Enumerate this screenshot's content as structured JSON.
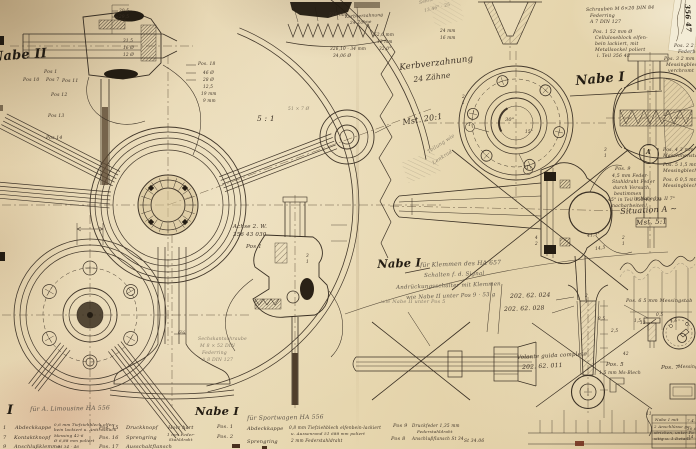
{
  "colors": {
    "paper": "#e6d6ae",
    "ink": "#3c3126",
    "ink_dark": "#241d13",
    "pencil": "#8a7f6b",
    "tape_dark": "#221a10",
    "patch_white": "#f3ecd6",
    "red_mark": "#6e2a18"
  },
  "texts": {
    "headings": [
      {
        "n": "nabe2-title",
        "t": "Nabe II",
        "x": -9,
        "y": 51,
        "s": 13,
        "r": -4,
        "st": "heavy"
      },
      {
        "n": "kerbverzahnung-label",
        "t": "Kerbverzahnung",
        "x": 399,
        "y": 64,
        "s": 8.5,
        "r": -7
      },
      {
        "n": "kerbverzahnung-teeth",
        "t": "24 Zähne",
        "x": 413,
        "y": 76,
        "s": 7.5,
        "r": -7
      },
      {
        "n": "scale-20-1",
        "t": "Mst. 20:1",
        "x": 402,
        "y": 119,
        "s": 8,
        "r": -9
      },
      {
        "n": "nabe1-top-title",
        "t": "Nabe I",
        "x": 575,
        "y": 75,
        "s": 13,
        "r": -5,
        "st": "heavy"
      },
      {
        "n": "nabe1-center-title",
        "t": "Nabe I",
        "x": 377,
        "y": 259,
        "s": 11.5,
        "r": -2,
        "st": "heavy"
      },
      {
        "n": "situation-a-title",
        "t": "Situation A ~",
        "x": 620,
        "y": 208,
        "s": 8,
        "r": -3
      },
      {
        "n": "situation-a-scale",
        "t": "Mst. 5:1",
        "x": 636,
        "y": 220,
        "s": 7,
        "r": -3
      },
      {
        "n": "nabe1-bottom-title",
        "t": "Nabe I",
        "x": 195,
        "y": 406,
        "s": 11.5,
        "r": 0,
        "st": "heavy"
      },
      {
        "n": "bottom-left-numeral",
        "t": "I",
        "x": 7,
        "y": 404,
        "s": 13,
        "r": 0,
        "st": "heavy"
      },
      {
        "n": "scale-5-1",
        "t": "5 : 1",
        "x": 257,
        "y": 115,
        "s": 7.5
      },
      {
        "n": "patch-number",
        "t": "356 47",
        "x": 691,
        "y": 4,
        "s": 7,
        "r": 87,
        "st": "heavy"
      }
    ],
    "notes": [
      {
        "t": "für Klemmen des HA 657",
        "x": 420,
        "y": 263,
        "s": 6,
        "r": -2,
        "st": "pencil2"
      },
      {
        "t": "Schalten f. d. Signal",
        "x": 424,
        "y": 274,
        "s": 5.5,
        "r": -2,
        "st": "pencil2"
      },
      {
        "t": "Andrückungsschalter mit Klemmen",
        "x": 396,
        "y": 286,
        "s": 5.5,
        "r": -2,
        "st": "pencil2"
      },
      {
        "t": "wie Nabe II unter Pos 9 · 53 g",
        "x": 406,
        "y": 296,
        "s": 5.5,
        "r": -2,
        "st": "pencil2"
      },
      {
        "t": "für A. Limousine HA 556",
        "x": 30,
        "y": 407,
        "s": 6,
        "r": -1,
        "st": "pencil2"
      },
      {
        "t": "für Sportwagen HA 556",
        "x": 247,
        "y": 416,
        "s": 6,
        "r": -1,
        "st": "pencil2"
      },
      {
        "t": "Pos. 9",
        "x": 615,
        "y": 168,
        "s": 4.8
      },
      {
        "t": "4,5 mm Feder-",
        "x": 612,
        "y": 175,
        "s": 4.6
      },
      {
        "t": "Stahldraht Feder",
        "x": 612,
        "y": 181,
        "s": 4.6
      },
      {
        "t": "durch Versuch",
        "x": 613,
        "y": 187,
        "s": 4.6
      },
      {
        "t": "bestimmen",
        "x": 614,
        "y": 193,
        "s": 4.6
      },
      {
        "t": "45° in Teil 356 43 033",
        "x": 608,
        "y": 199,
        "s": 4.4
      },
      {
        "t": "nacharbeiten!",
        "x": 612,
        "y": 205,
        "s": 4.6
      },
      {
        "t": "Pos. 2  2 mm",
        "x": 674,
        "y": 45,
        "s": 4.6
      },
      {
        "t": "Federblech",
        "x": 678,
        "y": 51,
        "s": 4.6
      },
      {
        "t": "Pos. 3  2 mm",
        "x": 664,
        "y": 58,
        "s": 4.6
      },
      {
        "t": "Messingblech",
        "x": 666,
        "y": 64,
        "s": 4.6
      },
      {
        "t": "verchromt",
        "x": 668,
        "y": 70,
        "s": 4.6
      },
      {
        "t": "Pos. 4  3 mm",
        "x": 663,
        "y": 149,
        "s": 4.6
      },
      {
        "t": "Maschinenstahl",
        "x": 663,
        "y": 155,
        "s": 4.6
      },
      {
        "t": "Pos. 5  1,5 mm",
        "x": 663,
        "y": 164,
        "s": 4.6
      },
      {
        "t": "Messingblech",
        "x": 663,
        "y": 170,
        "s": 4.6
      },
      {
        "t": "Pos. 6  0,5 mm",
        "x": 663,
        "y": 179,
        "s": 4.6
      },
      {
        "t": "Messingblech",
        "x": 663,
        "y": 185,
        "s": 4.6
      },
      {
        "t": "in Nabe I u. II  7°",
        "x": 634,
        "y": 198,
        "s": 4.4
      },
      {
        "t": "Schrauben M 6×20 DIN 84",
        "x": 586,
        "y": 9,
        "s": 4.6,
        "r": -2
      },
      {
        "t": "Federring",
        "x": 590,
        "y": 15,
        "s": 4.6
      },
      {
        "t": "A 7 DIN 127",
        "x": 590,
        "y": 21,
        "s": 4.6
      },
      {
        "t": "Pos. 1   52 mm Ø",
        "x": 593,
        "y": 31,
        "s": 4.6
      },
      {
        "t": "Celluloseblock elfen-",
        "x": 595,
        "y": 37,
        "s": 4.6
      },
      {
        "t": "bein lackiert, mit",
        "x": 595,
        "y": 43,
        "s": 4.6
      },
      {
        "t": "Metallsockel poliert",
        "x": 595,
        "y": 49,
        "s": 4.6
      },
      {
        "t": "i. Teil 356 43",
        "x": 597,
        "y": 55,
        "s": 4.6
      },
      {
        "t": "Achse 2. W.",
        "x": 233,
        "y": 225,
        "s": 5.5
      },
      {
        "t": "356 43 030",
        "x": 233,
        "y": 233,
        "s": 5.5
      },
      {
        "t": "Pos 1",
        "x": 246,
        "y": 245,
        "s": 5.5
      },
      {
        "t": "Sechskantschraube",
        "x": 198,
        "y": 338,
        "s": 4.6,
        "st": "pencil"
      },
      {
        "t": "M 8 × 52 DIN",
        "x": 200,
        "y": 345,
        "s": 4.6,
        "st": "pencil"
      },
      {
        "t": "Federring",
        "x": 202,
        "y": 352,
        "s": 4.6,
        "st": "pencil"
      },
      {
        "t": "A 8 DIN 127",
        "x": 202,
        "y": 359,
        "s": 4.6,
        "st": "pencil"
      },
      {
        "t": "Teilung wie",
        "x": 427,
        "y": 151,
        "s": 5,
        "r": -33,
        "st": "pencil"
      },
      {
        "t": "Lenkrad",
        "x": 432,
        "y": 162,
        "s": 5,
        "r": -33,
        "st": "pencil"
      },
      {
        "t": "202. 62. 024",
        "x": 510,
        "y": 294,
        "s": 6,
        "r": -2
      },
      {
        "t": "202. 62. 028",
        "x": 504,
        "y": 307,
        "s": 6,
        "r": -2
      },
      {
        "t": "Volante guida completo",
        "x": 517,
        "y": 356,
        "s": 5.5,
        "r": -3
      },
      {
        "t": "202. 62. 011",
        "x": 522,
        "y": 365,
        "s": 6,
        "r": -3
      },
      {
        "t": "Pos. 6  5 mm Messingstab",
        "x": 626,
        "y": 300,
        "s": 4.8
      },
      {
        "t": "Pos. 5",
        "x": 606,
        "y": 363,
        "s": 5.5
      },
      {
        "t": "1,5 mm Ms-Blech",
        "x": 599,
        "y": 372,
        "s": 4.4
      },
      {
        "t": "Pos. 7",
        "x": 661,
        "y": 366,
        "s": 5.5
      },
      {
        "t": "Messing",
        "x": 678,
        "y": 366,
        "s": 4.4
      },
      {
        "t": "wie Nabe II unter Pos 5",
        "x": 381,
        "y": 300,
        "s": 5,
        "st": "pencil"
      },
      {
        "t": "Kerbverzahnung",
        "x": 345,
        "y": 15,
        "s": 4.2,
        "r": -3
      },
      {
        "t": "24 Zähne",
        "x": 350,
        "y": 21,
        "s": 4.2,
        "r": -3
      },
      {
        "t": "51 × 7 Ø",
        "x": 288,
        "y": 108,
        "s": 4.4,
        "st": "pencil"
      }
    ],
    "dimensions": [
      {
        "t": "320 mm",
        "x": 329,
        "y": 13,
        "s": 4.2
      },
      {
        "t": "326,10 · 34 mm",
        "x": 330,
        "y": 47,
        "s": 4.2
      },
      {
        "t": "34,06 Ø",
        "x": 333,
        "y": 54,
        "s": 4.2
      },
      {
        "t": "30,5",
        "x": 119,
        "y": 9,
        "s": 4.2
      },
      {
        "t": "29,5",
        "x": 119,
        "y": 15,
        "s": 4.2
      },
      {
        "t": "31,5",
        "x": 123,
        "y": 39,
        "s": 4.2
      },
      {
        "t": "16 Ø",
        "x": 123,
        "y": 46,
        "s": 4.2
      },
      {
        "t": "12 Ø",
        "x": 123,
        "y": 53,
        "s": 4.2
      },
      {
        "t": "Pos. 18",
        "x": 198,
        "y": 63,
        "s": 4.4
      },
      {
        "t": "46 Ø",
        "x": 203,
        "y": 71,
        "s": 4.2
      },
      {
        "t": "28 Ø",
        "x": 203,
        "y": 78,
        "s": 4.2
      },
      {
        "t": "12,5",
        "x": 203,
        "y": 85,
        "s": 4.2
      },
      {
        "t": "19 mm",
        "x": 201,
        "y": 92,
        "s": 4.2
      },
      {
        "t": "9 mm",
        "x": 203,
        "y": 99,
        "s": 4.2
      },
      {
        "t": "Pos 1",
        "x": 44,
        "y": 71,
        "s": 4.6
      },
      {
        "t": "Pos 10",
        "x": 23,
        "y": 79,
        "s": 4.6
      },
      {
        "t": "Pos 7",
        "x": 46,
        "y": 79,
        "s": 4.6
      },
      {
        "t": "Pos 11",
        "x": 62,
        "y": 80,
        "s": 4.6
      },
      {
        "t": "Pos 12",
        "x": 51,
        "y": 94,
        "s": 4.6
      },
      {
        "t": "Pos 13",
        "x": 48,
        "y": 115,
        "s": 4.6
      },
      {
        "t": "Pos 14",
        "x": 46,
        "y": 137,
        "s": 4.6
      },
      {
        "t": "52,0 mm",
        "x": 374,
        "y": 33,
        "s": 4.2
      },
      {
        "t": "12 mm",
        "x": 377,
        "y": 40,
        "s": 4.2
      },
      {
        "t": "32,0°",
        "x": 379,
        "y": 47,
        "s": 4.2
      },
      {
        "t": "Sehne 13 mm",
        "x": 419,
        "y": 2,
        "s": 4.4,
        "r": -14,
        "st": "pencil"
      },
      {
        "t": "13,46° · 25",
        "x": 424,
        "y": 10,
        "s": 4.4,
        "r": -14,
        "st": "pencil"
      },
      {
        "t": "24 mm",
        "x": 440,
        "y": 29,
        "s": 4.2
      },
      {
        "t": "16 mm",
        "x": 440,
        "y": 36,
        "s": 4.2
      },
      {
        "t": "30°",
        "x": 505,
        "y": 118,
        "s": 5
      },
      {
        "t": "15°",
        "x": 525,
        "y": 130,
        "s": 4.2
      },
      {
        "t": "1",
        "x": 468,
        "y": 124,
        "s": 4.5
      },
      {
        "t": "1",
        "x": 526,
        "y": 167,
        "s": 4.5
      },
      {
        "t": "A",
        "x": 646,
        "y": 150,
        "s": 6,
        "st": "heavy"
      },
      {
        "t": "41,5°",
        "x": 587,
        "y": 235,
        "s": 4.4,
        "r": -8
      },
      {
        "t": "14,5",
        "x": 595,
        "y": 248,
        "s": 4.4,
        "r": -8
      },
      {
        "t": "0,5",
        "x": 656,
        "y": 313,
        "s": 4.2
      },
      {
        "t": "4,5",
        "x": 670,
        "y": 319,
        "s": 4.2
      },
      {
        "t": "1,5",
        "x": 634,
        "y": 319,
        "s": 4.2
      },
      {
        "t": "42",
        "x": 623,
        "y": 352,
        "s": 4.2
      },
      {
        "t": "12",
        "x": 640,
        "y": 321,
        "s": 4.2
      },
      {
        "t": "8,5",
        "x": 598,
        "y": 317,
        "s": 4.2
      },
      {
        "t": "2,5",
        "x": 611,
        "y": 329,
        "s": 4.2
      },
      {
        "t": "6¼",
        "x": 178,
        "y": 332,
        "s": 4.4
      },
      {
        "t": "2",
        "x": 462,
        "y": 95,
        "s": 4.2
      },
      {
        "t": "1",
        "x": 462,
        "y": 101,
        "s": 4.2
      },
      {
        "t": "3",
        "x": 604,
        "y": 148,
        "s": 4.2
      },
      {
        "t": "1",
        "x": 604,
        "y": 154,
        "s": 4.2
      },
      {
        "t": "2",
        "x": 622,
        "y": 236,
        "s": 4.2
      },
      {
        "t": "1",
        "x": 622,
        "y": 242,
        "s": 4.2
      },
      {
        "t": "4",
        "x": 535,
        "y": 236,
        "s": 4.2
      },
      {
        "t": "2",
        "x": 535,
        "y": 242,
        "s": 4.2
      },
      {
        "t": "3",
        "x": 306,
        "y": 254,
        "s": 4.2
      },
      {
        "t": "1",
        "x": 306,
        "y": 260,
        "s": 4.2
      },
      {
        "t": "2",
        "x": 585,
        "y": 294,
        "s": 4.2
      },
      {
        "t": "1",
        "x": 585,
        "y": 300,
        "s": 4.2
      },
      {
        "t": "St 34.06",
        "x": 464,
        "y": 440,
        "s": 4.4
      }
    ],
    "parts_list": [
      {
        "t": "1",
        "x": 3,
        "y": 426,
        "s": 5
      },
      {
        "t": "Abdeckkappe",
        "x": 15,
        "y": 426,
        "s": 5
      },
      {
        "t": "0,6 mm Tiefziehblech elfen-",
        "x": 54,
        "y": 423,
        "s": 4
      },
      {
        "t": "bein lackiert u. Antirostlack",
        "x": 54,
        "y": 428,
        "s": 4
      },
      {
        "t": "Pos. 15",
        "x": 99,
        "y": 426,
        "s": 5
      },
      {
        "t": "Druckknopf",
        "x": 126,
        "y": 426,
        "s": 5
      },
      {
        "t": "Holz hart",
        "x": 168,
        "y": 426,
        "s": 5
      },
      {
        "t": "Pos. 1",
        "x": 217,
        "y": 425,
        "s": 5
      },
      {
        "t": "7",
        "x": 3,
        "y": 436,
        "s": 5
      },
      {
        "t": "Kontaktknopf",
        "x": 14,
        "y": 436,
        "s": 5
      },
      {
        "t": "Messing 42-6",
        "x": 54,
        "y": 434,
        "s": 4
      },
      {
        "t": "Ø 6,88 mm poliert",
        "x": 54,
        "y": 439,
        "s": 4
      },
      {
        "t": "Pos. 16",
        "x": 99,
        "y": 436,
        "s": 5
      },
      {
        "t": "Sprengring",
        "x": 126,
        "y": 436,
        "s": 5
      },
      {
        "t": "1 mm Feder-",
        "x": 167,
        "y": 433,
        "s": 4
      },
      {
        "t": "Stahldraht",
        "x": 169,
        "y": 438,
        "s": 4
      },
      {
        "t": "Pos. 2",
        "x": 217,
        "y": 435,
        "s": 5
      },
      {
        "t": "9",
        "x": 3,
        "y": 445,
        "s": 5
      },
      {
        "t": "Anschlußklemme",
        "x": 14,
        "y": 445,
        "s": 5
      },
      {
        "t": "M 34 · 46",
        "x": 58,
        "y": 445,
        "s": 4
      },
      {
        "t": "Pos. 17",
        "x": 99,
        "y": 445,
        "s": 5
      },
      {
        "t": "Ausschaltflansch",
        "x": 126,
        "y": 445,
        "s": 5
      },
      {
        "t": "Abdeckkappe",
        "x": 247,
        "y": 427,
        "s": 5
      },
      {
        "t": "0,8 mm Tiefziehblech elfenbein-lackiert",
        "x": 289,
        "y": 426,
        "s": 4.2
      },
      {
        "t": "u. Aussenrand 51 688 mm poliert",
        "x": 291,
        "y": 432,
        "s": 4
      },
      {
        "t": "Sprengring",
        "x": 247,
        "y": 440,
        "s": 5
      },
      {
        "t": "2 mm Federstahldraht",
        "x": 291,
        "y": 439,
        "s": 4.2
      },
      {
        "t": "Pos 9",
        "x": 393,
        "y": 424,
        "s": 5
      },
      {
        "t": "Druckfeder  1,35 mm",
        "x": 412,
        "y": 424,
        "s": 4.2
      },
      {
        "t": "Federstahldraht",
        "x": 417,
        "y": 430,
        "s": 4
      },
      {
        "t": "Pos 8",
        "x": 391,
        "y": 437,
        "s": 5
      },
      {
        "t": "Anschlußflansch  St 34",
        "x": 412,
        "y": 437,
        "s": 4.2
      }
    ],
    "revision_table": [
      {
        "t": "11",
        "x": 646,
        "y": 412,
        "s": 4.2
      },
      {
        "t": "Nabe I mit",
        "x": 655,
        "y": 418,
        "s": 4
      },
      {
        "t": "2 Anschlüsse ge-",
        "x": 654,
        "y": 425,
        "s": 4
      },
      {
        "t": "strichen, unter Po-",
        "x": 654,
        "y": 431,
        "s": 4
      },
      {
        "t": "sitig u. 1 Details",
        "x": 654,
        "y": 437,
        "s": 4
      },
      {
        "t": "7.4.",
        "x": 687,
        "y": 419,
        "s": 4
      },
      {
        "t": "30.6.",
        "x": 687,
        "y": 427,
        "s": 4
      },
      {
        "t": "14.",
        "x": 688,
        "y": 435,
        "s": 4
      }
    ]
  }
}
